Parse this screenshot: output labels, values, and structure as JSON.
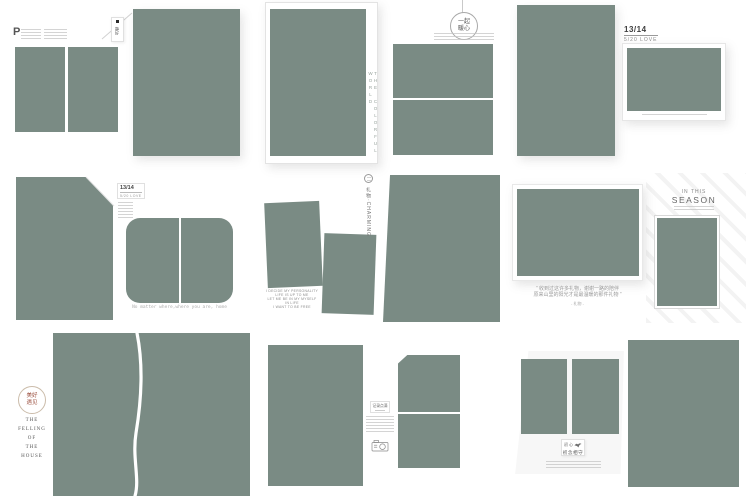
{
  "palette": {
    "photo_green": "#7a8b84",
    "page_white": "#ffffff",
    "accent_red": "#9b4f3f",
    "fine_gray": "#c2c2c2"
  },
  "t1": {
    "drop_cap": "P"
  },
  "t2": {
    "tag_text": "静好"
  },
  "t3": {
    "side_text": "THE COLORFUL WORLD"
  },
  "t4": {
    "seal_line1": "一起",
    "seal_line2": "暖心"
  },
  "t5": {
    "page_no": "13/14",
    "subtitle": "5/20 LOVE"
  },
  "t6": {
    "page_no": "13/14",
    "subtitle": "5/20 LOVE",
    "caption": "No matter where,where you are, home"
  },
  "t7": {
    "poem": [
      "I DECIDE MY PERSONALITY",
      "LIFE IS UP TO ME",
      "LET ME BE IN MY MYSELF",
      "IN LIFE",
      "I WANT TO BE FREE"
    ],
    "side_tag": "礼物·CHARMING"
  },
  "t8": {
    "quote_line1": "“ 收到过这许多礼物，谢谢一路的陪伴",
    "quote_line2": "原来山里的阳光才是最温暖的那件礼物 ”",
    "credit": "- 礼物 -",
    "heading_small": "IN THIS",
    "heading_large": "SEASON"
  },
  "t9": {
    "seal_line1": "美好",
    "seal_line2": "遇见",
    "title_words": [
      "THE",
      "FELLING",
      "OF",
      "THE",
      "HOUSE"
    ]
  },
  "t10": {
    "label": "记录点滴"
  },
  "t11": {
    "tag_top": "初 心",
    "tag_main": "初念相守"
  }
}
